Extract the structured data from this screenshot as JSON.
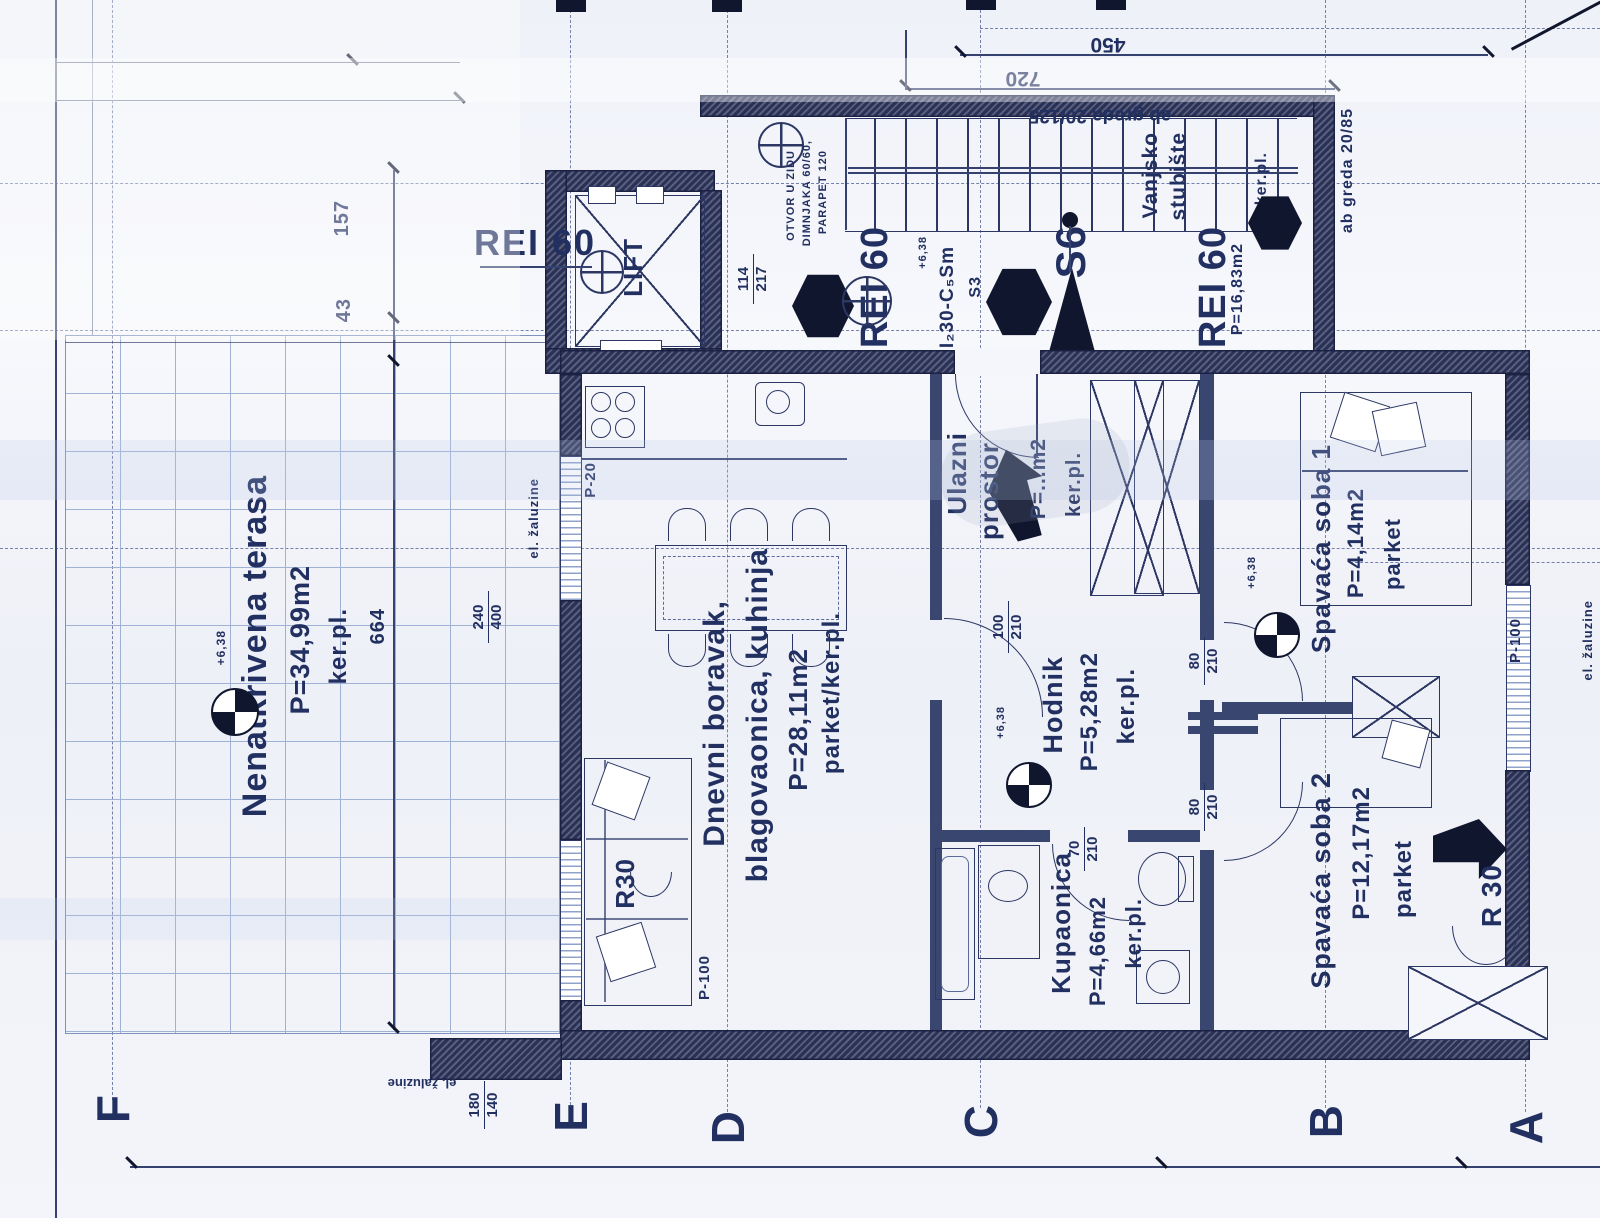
{
  "axes": {
    "f": "F",
    "e": "E",
    "d": "D",
    "c": "C",
    "b": "B",
    "a": "A",
    "top_b": "B"
  },
  "rooms": {
    "terasa": {
      "name": "Nenatkrivena terasa",
      "area": "P=34,99m2",
      "floor": "ker.pl."
    },
    "living": {
      "line1": "Dnevni boravak,",
      "line2": "blagovaonica, kuhinja",
      "area": "P=28,11m2",
      "floor": "parket/ker.pl."
    },
    "ulaz": {
      "line1": "Ulazni",
      "line2": "prostor",
      "area": "P=...m2",
      "floor": "ker.pl."
    },
    "hodnik": {
      "name": "Hodnik",
      "area": "P=5,28m2",
      "floor": "ker.pl."
    },
    "kupaonica": {
      "name": "Kupaonica",
      "area": "P=4,66m2",
      "floor": "ker.pl."
    },
    "soba1": {
      "name": "Spavaća soba 1",
      "area": "P=4,14m2",
      "floor": "parket"
    },
    "soba2": {
      "name": "Spavaća soba 2",
      "area": "P=12,17m2",
      "floor": "parket"
    },
    "stubiste": {
      "name1": "Vanjsko",
      "name2": "stubište",
      "area": "P=16,83m2",
      "floor": "ker.pl."
    },
    "lift": {
      "name": "LIFT"
    }
  },
  "fire": {
    "rei60": "REI 60",
    "r30": "R30",
    "r30_2": "R 30",
    "door_class": "EI₂30-C₅Sm"
  },
  "marks": {
    "s6": "S6",
    "s3": "S3",
    "p20": "P-20",
    "p100": "P-100",
    "elev": "+6,38"
  },
  "notes": {
    "zaluzine": "el. žaluzine",
    "greda_stropna": "ab greda 20/125",
    "greda_rubna": "ab greda 20/85",
    "otvor1": "OTVOR U ZIDU",
    "otvor2": "DIMNJAKA 60/60,",
    "otvor3": "PARAPET 120"
  },
  "dims": {
    "terasa_h": "664",
    "t157": "157",
    "t43": "43",
    "stair_run": "720",
    "stair_total": "450",
    "lift_niche": {
      "a": "114",
      "b": "217"
    },
    "kuh_win": {
      "a": "240",
      "b": "400"
    },
    "door_ulaz": {
      "a": "100",
      "b": "210"
    },
    "door_soba": {
      "a": "80",
      "b": "210"
    },
    "door_kupa": {
      "a": "70",
      "b": "210"
    },
    "win_d": {
      "a": "180",
      "b": "140"
    }
  },
  "colors": {
    "ink": "#223061",
    "wall": "#2a3157",
    "paper": "#f2f4fa"
  }
}
